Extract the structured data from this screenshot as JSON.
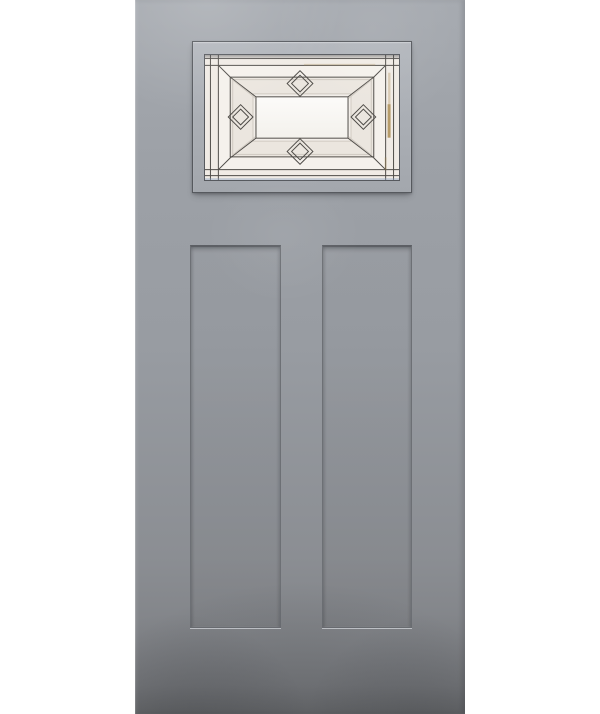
{
  "scene": {
    "label": "Product photo of a gray craftsman-style entry door",
    "door_label": "Gray painted craftsman door slab",
    "lite_label": "Decorative beveled and leaded glass lite",
    "glass_label": "Beveled glass pattern with center pane and four diamonds",
    "left_panel_label": "Left recessed flat panel",
    "right_panel_label": "Right recessed flat panel"
  },
  "colors": {
    "bg": "#ffffff",
    "door_top": "#a6aab0",
    "door_upper": "#9da1a7",
    "door_mid": "#989ca2",
    "door_lower": "#8b8e93",
    "door_bottom": "#7b7d81",
    "door_edge_bottom": "#6f7174",
    "groove_dark": "#5c5f64",
    "groove_mid": "#6d7075",
    "groove_light": "#c6c9ce",
    "frame_edge": "#56595e",
    "molding_top": "#b2b6bc",
    "molding_bottom": "#a3a7ad",
    "glass_top": "#f7f5f1",
    "glass_bottom": "#eeeae3",
    "lead": "#4f4c48",
    "bevel": "#cdc7bf",
    "band_outer": "#f0ebe5",
    "band_inner": "#f5f1ec",
    "band_frame": "#ebe6df",
    "band_step": "#f2eee9",
    "pane_center": "#fbfaf7",
    "diamond_outer": "#faf8f5",
    "diamond_inner": "#f1ede7",
    "amber": "#a8874a",
    "glass_edge_blue": "#8ca2c0"
  }
}
